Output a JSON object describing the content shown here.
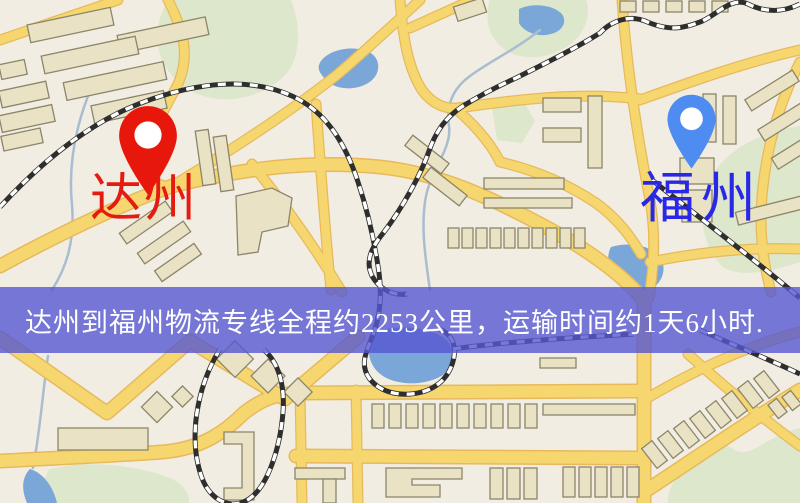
{
  "page": {
    "width": 800,
    "height": 503
  },
  "map": {
    "origin_marker": {
      "label": "达州",
      "pin_icon": "red-location-pin"
    },
    "destination_marker": {
      "label": "福州",
      "pin_icon": "blue-location-pin"
    },
    "banner": {
      "text": "达州到福州物流专线全程约2253公里，运输时间约1天6小时."
    },
    "colors": {
      "background": "#f2ede2",
      "road": "#f6d76f",
      "road_border": "#e7b95c",
      "park": "#dde7cb",
      "water": "#7aa7d8",
      "building": "#eae2c4",
      "building_outline": "#8b856a",
      "railway_dark": "#2e2e2e",
      "railway_light": "#ffffff",
      "stream": "#a8bdd0",
      "pin_origin": "#e8170b",
      "pin_destination": "#4e8cf2",
      "label_origin": "#e51a10",
      "label_destination": "#2828e6",
      "banner_bg": "#5557d2",
      "banner_text": "#ffffff"
    }
  }
}
